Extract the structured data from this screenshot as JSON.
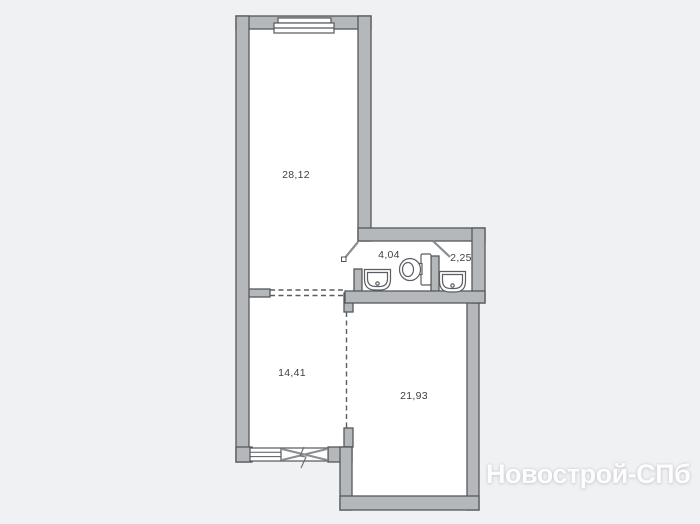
{
  "floorplan": {
    "rooms": [
      {
        "name": "room-top",
        "area_label": "28,12"
      },
      {
        "name": "hallway",
        "area_label": "4,04"
      },
      {
        "name": "bathroom",
        "area_label": "2,25"
      },
      {
        "name": "room-bottom-left",
        "area_label": "14,41"
      },
      {
        "name": "room-bottom-right",
        "area_label": "21,93"
      }
    ],
    "fixtures": [
      "toilet-icon",
      "sink-icon",
      "sink-icon"
    ],
    "watermark_text": "Новострой-СПб",
    "colors": {
      "background": "#f0f1f2",
      "floor": "#ffffff",
      "wall_fill": "#b5b8ba",
      "wall_stroke": "#54585c",
      "label_text": "#3c4146",
      "watermark_text": "#ffffff",
      "door_leaf": "#8a8e91"
    }
  }
}
